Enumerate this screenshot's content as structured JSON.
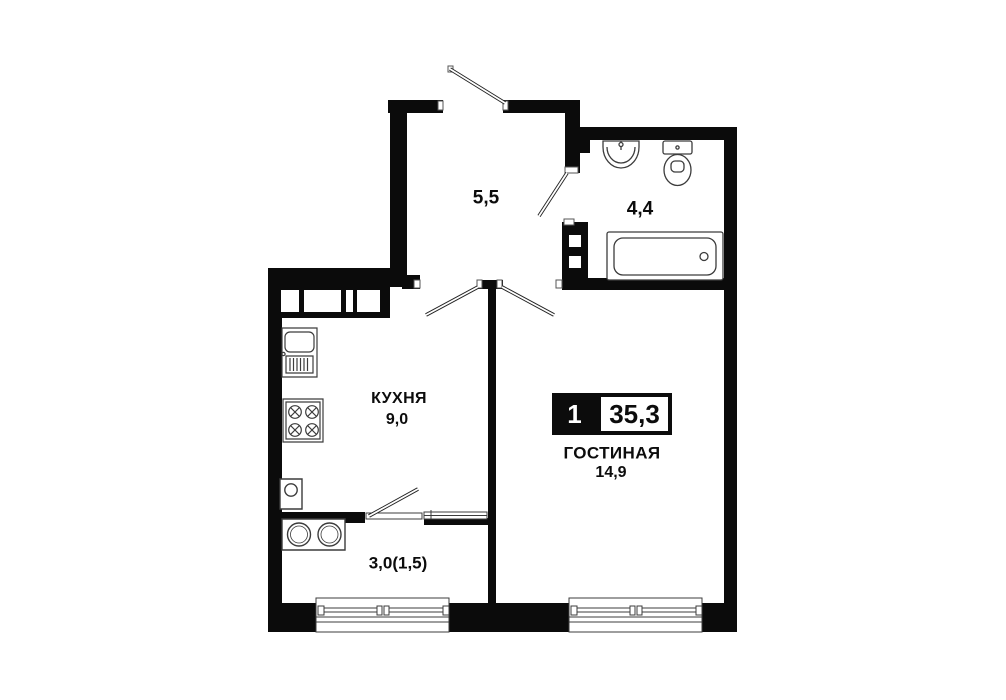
{
  "plan": {
    "type": "apartment-floor-plan",
    "badge": {
      "room_count": "1",
      "total_area": "35,3"
    },
    "rooms": {
      "hallway": {
        "area": "5,5"
      },
      "bathroom": {
        "area": "4,4"
      },
      "kitchen": {
        "name": "КУХНЯ",
        "area": "9,0"
      },
      "living_room": {
        "name": "ГОСТИНАЯ",
        "area": "14,9"
      },
      "balcony": {
        "area": "3,0(1,5)"
      }
    },
    "fixtures": [
      "entry-door",
      "bathroom-door",
      "kitchen-door",
      "living-room-door",
      "balcony-door",
      "washbasin",
      "toilet",
      "bathtub",
      "towel-rail",
      "vent-shaft",
      "kitchen-sink",
      "stove",
      "washing-machine",
      "washer-dryer-columns",
      "balcony-window",
      "living-room-window"
    ],
    "colors": {
      "wall": "#0b0b0b",
      "fixture_outline": "#3c3c3c",
      "background": "#ffffff"
    }
  }
}
